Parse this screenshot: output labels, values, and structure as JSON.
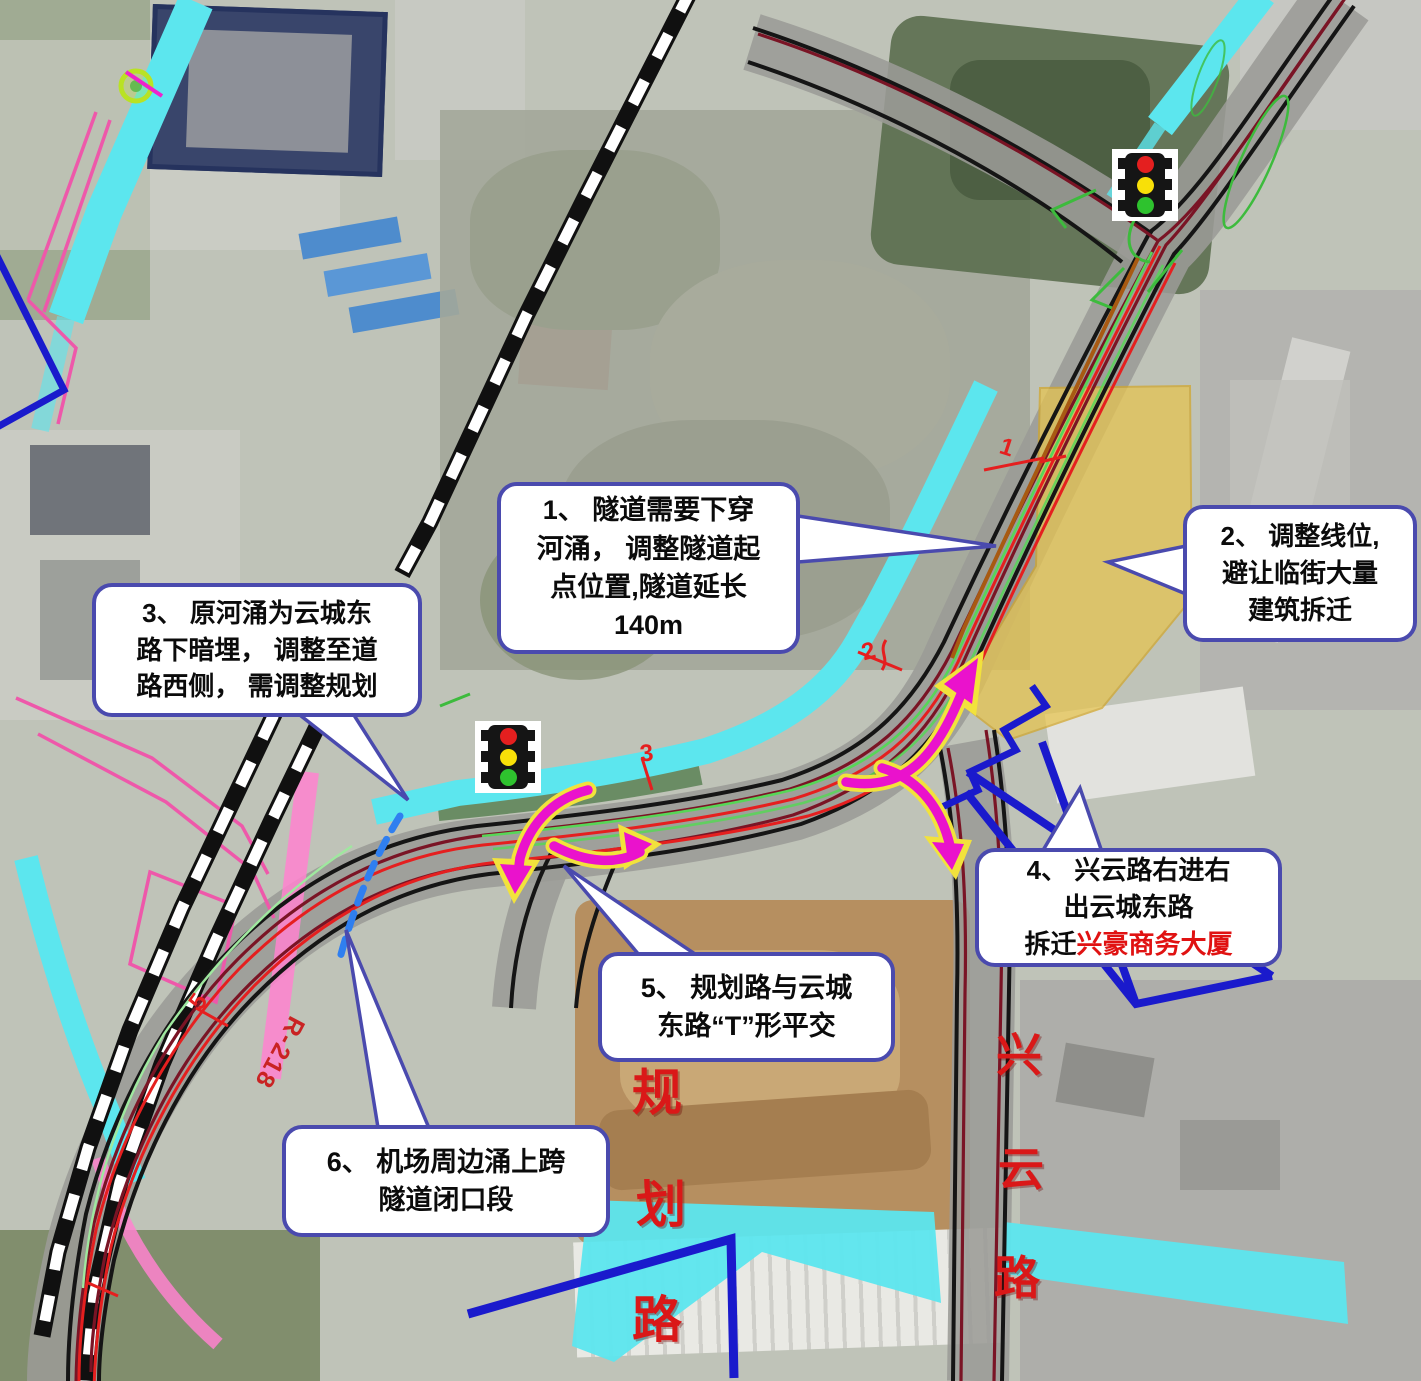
{
  "colors": {
    "callout-border": "#4a4aae",
    "river-cyan": "#5ce6ee",
    "demolition-yellow": "#e7c44e",
    "road-edge": "#151515",
    "road-maroon": "#7a1425",
    "line-red": "#e51f1f",
    "line-green": "#57d657",
    "line-orange": "#a85a12",
    "line-blue": "#1a1acc",
    "dash-blue": "#2f7ff0",
    "arrow-magenta": "#ea12cc",
    "arrow-halo": "#f2e23c",
    "label-red": "#da1818",
    "tl-red": "#e41f1f",
    "tl-yellow": "#f8e008",
    "tl-green": "#2ec22e"
  },
  "callouts": {
    "c1": {
      "text": "1、 隧道需要下穿\n河涌， 调整隧道起\n点位置,隧道延长\n140m"
    },
    "c2": {
      "text": "2、 调整线位,\n避让临街大量\n建筑拆迁"
    },
    "c3": {
      "text": "3、 原河涌为云城东\n路下暗埋， 调整至道\n路西侧， 需调整规划"
    },
    "c4": {
      "text": "4、 兴云路右进右\n出云城东路",
      "line3_prefix": "拆迁",
      "line3_highlight": "兴豪商务大厦"
    },
    "c5": {
      "text": "5、 规划路与云城\n东路“T”形平交"
    },
    "c6": {
      "text": "6、 机场周边涌上跨\n隧道闭口段"
    }
  },
  "road_labels": {
    "xingyun": {
      "name": "兴云路",
      "chars": [
        "兴",
        "云",
        "路"
      ]
    },
    "guihua": {
      "name": "规划路",
      "chars": [
        "规",
        "划",
        "路"
      ]
    }
  },
  "annotations": {
    "curve_radius": "R-218",
    "stations": {
      "s1": "1",
      "s2": "2",
      "s3": "3",
      "s5": "5"
    }
  },
  "icons": {
    "traffic_light": "traffic-light-icon",
    "traffic_light_count": 2
  }
}
